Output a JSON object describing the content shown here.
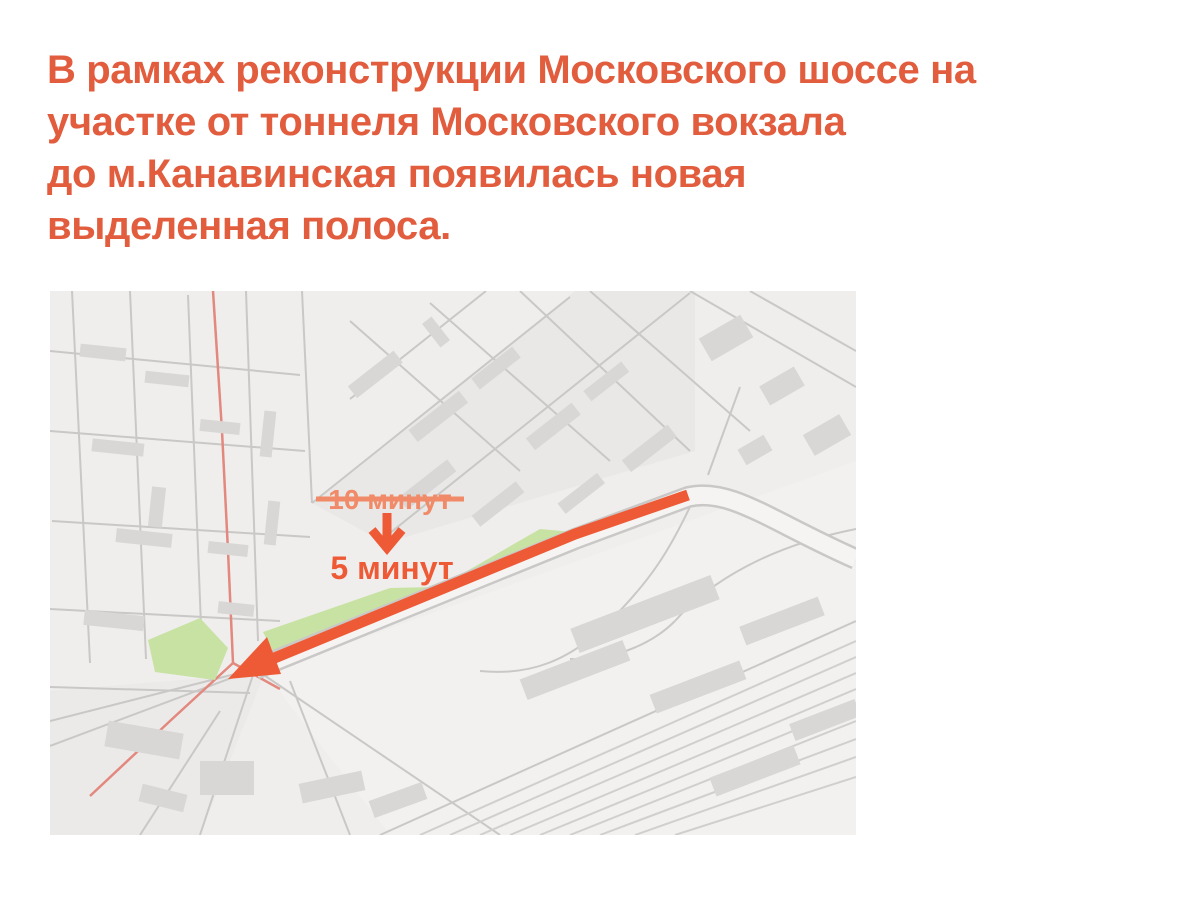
{
  "headline": {
    "text": "В рамках реконструкции Московского шоссе на\nучастке от тоннеля Московского вокзала\nдо м.Канавинская появилась новая\nвыделенная полоса."
  },
  "map": {
    "annotation": {
      "old_time": "10 минут",
      "new_time": "5 минут"
    }
  },
  "colors": {
    "accent": "#e25c3e",
    "route": "#ee5a36",
    "faded": "#f08a68",
    "green": "#c8e2a4",
    "map_bg": "#efeeec",
    "block": "#e9e8e6",
    "yard": "#f2f1ef",
    "building": "#d8d7d5",
    "street": "#c9c8c6",
    "rail": "#d0cfcd",
    "road_fill": "#f5f4f3",
    "red_road": "#e2887e"
  }
}
